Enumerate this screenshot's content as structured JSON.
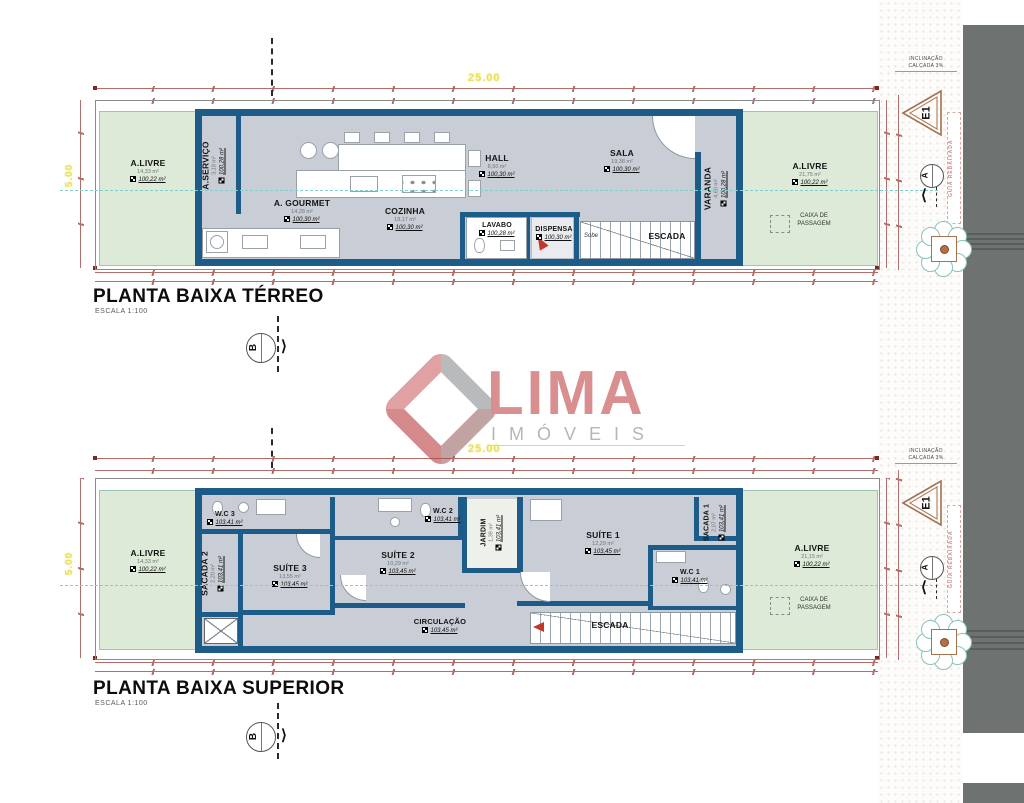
{
  "colors": {
    "wall": "#1d5c88",
    "floor": "#c9cdd5",
    "green": "#dcead7",
    "logo_pink": "#d98e90",
    "logo_gray": "#b5b6b8",
    "dim_red": "#a14b45",
    "dim_yellow": "#e8e05a",
    "section_teal": "#7fd0cc",
    "band_gray": "#6e7270"
  },
  "logo": {
    "name": "LIMA",
    "subtitle": "IMÓVEIS"
  },
  "dims": {
    "width": "25.00",
    "height": "5.00"
  },
  "titles": {
    "ground": {
      "title": "PLANTA BAIXA TÉRREO",
      "scale": "ESCALA 1:100"
    },
    "upper": {
      "title": "PLANTA BAIXA SUPERIOR",
      "scale": "ESCALA 1:100"
    }
  },
  "side": {
    "incline1": "INCLINAÇÃO",
    "incline2": "CALÇADA 3%",
    "e1": "E1",
    "a": "A",
    "b": "B",
    "street": "GUIA REBAIXADA"
  },
  "ground": {
    "sobe": "Sobe",
    "caixa": "CAIXA DE PASSAGEM",
    "rooms": [
      {
        "label": "A.LIVRE",
        "area": "14,33 m²",
        "level": "100,22 m²"
      },
      {
        "label": "A.SERVIÇO",
        "area": "3,18 m²",
        "level": "100,28 m²"
      },
      {
        "label": "A. GOURMET",
        "area": "14,28 m²",
        "level": "100,30 m²"
      },
      {
        "label": "COZINHA",
        "area": "18,17 m²",
        "level": "100,30 m²"
      },
      {
        "label": "HALL",
        "area": "8,50 m²",
        "level": "100,30 m²"
      },
      {
        "label": "SALA",
        "area": "19,38 m²",
        "level": "100,30 m²"
      },
      {
        "label": "VARANDA",
        "area": "4,60 m²",
        "level": "100,28 m²"
      },
      {
        "label": "LAVABO",
        "area": "1,75 m²",
        "level": "100,28 m²"
      },
      {
        "label": "DISPENSA",
        "area": "1,43 m²",
        "level": "100,30 m²"
      },
      {
        "label": "ESCADA"
      },
      {
        "label": "A.LIVRE",
        "area": "21,75 m²",
        "level": "100,22 m²"
      }
    ]
  },
  "upper": {
    "caixa": "CAIXA DE PASSAGEM",
    "rooms": [
      {
        "label": "A.LIVRE",
        "area": "14,33 m²",
        "level": "100,22 m²"
      },
      {
        "label": "W.C 3",
        "area": "2,55 m²",
        "level": "103,41 m²"
      },
      {
        "label": "SACADA 2",
        "area": "2,20 m²",
        "level": "103,41 m²"
      },
      {
        "label": "SUÍTE 3",
        "area": "13,55 m²",
        "level": "103,45 m²"
      },
      {
        "label": "W.C 2",
        "area": "2,38 m²",
        "level": "103,41 m²"
      },
      {
        "label": "SUÍTE 2",
        "area": "10,29 m²",
        "level": "103,45 m²"
      },
      {
        "label": "JARDIM",
        "area": "1,39 m²",
        "level": "103,41 m²"
      },
      {
        "label": "SUÍTE 1",
        "area": "12,29 m²",
        "level": "103,45 m²"
      },
      {
        "label": "SACADA 1",
        "area": "2,07 m²",
        "level": "103,41 m²"
      },
      {
        "label": "W.C 1",
        "area": "2,92 m²",
        "level": "103,41 m²"
      },
      {
        "label": "CIRCULAÇÃO",
        "area": "7,03 m²",
        "level": "103,45 m²"
      },
      {
        "label": "ESCADA"
      },
      {
        "label": "A.LIVRE",
        "area": "21,15 m²",
        "level": "100,22 m²"
      }
    ]
  }
}
